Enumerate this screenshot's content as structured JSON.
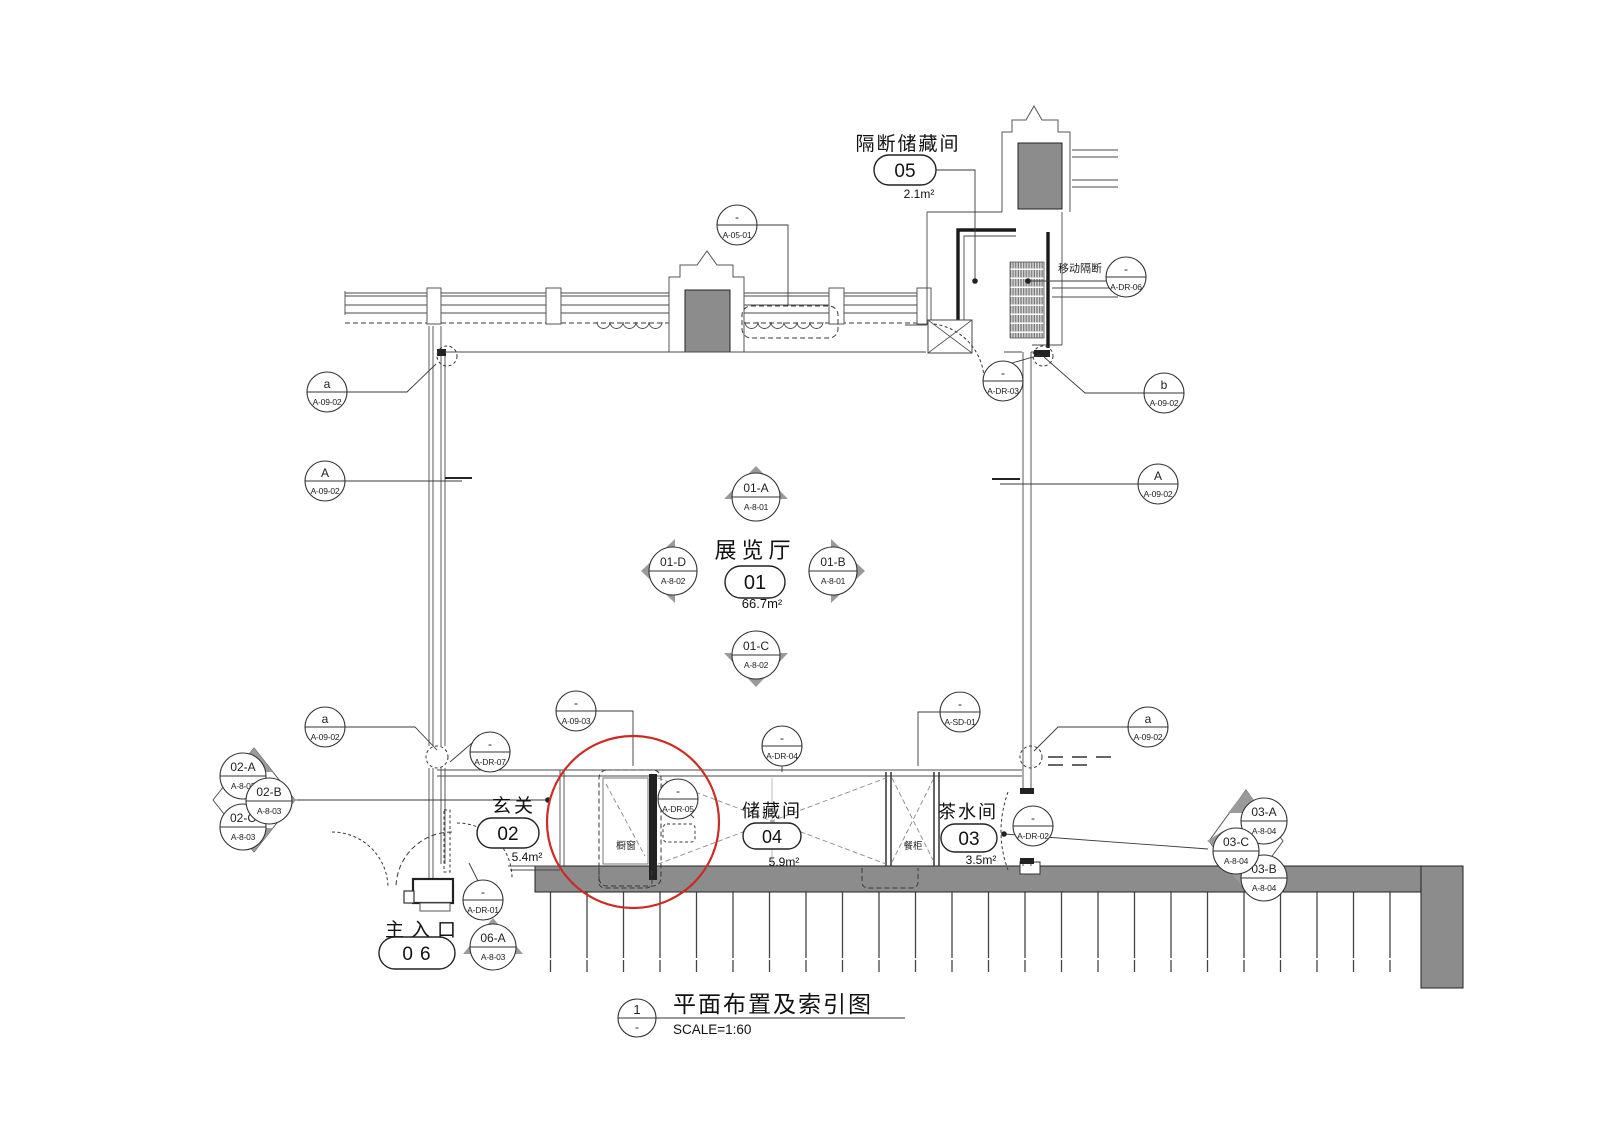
{
  "colors": {
    "line": "#3b3b3b",
    "wall_gray": "#8c8c8c",
    "marker_gray": "#9a9a9a",
    "highlight_red": "#cc2b24"
  },
  "title_block": {
    "number": "1",
    "revision": "-",
    "title": "平面布置及索引图",
    "scale": "SCALE=1:60"
  },
  "rooms": {
    "exhibition": {
      "name": "展览厅",
      "number": "01",
      "area": "66.7m²"
    },
    "entry": {
      "name": "玄关",
      "number": "02",
      "area": "5.4m²"
    },
    "tea": {
      "name": "茶水间",
      "number": "03",
      "area": "3.5m²"
    },
    "storage": {
      "name": "储藏间",
      "number": "04",
      "area": "5.9m²"
    },
    "partition_storage": {
      "name": "隔断储藏间",
      "number": "05",
      "area": "2.1m²"
    },
    "main_entrance": {
      "name": "主入口",
      "number": "06"
    }
  },
  "annotations": {
    "movable_partition": "移动隔断",
    "display_window": "橱窗",
    "sideboard": "餐柜"
  },
  "axis_bubbles": {
    "a_top_left": {
      "label": "a",
      "code": "A-09-02"
    },
    "A_left": {
      "label": "A",
      "code": "A-09-02"
    },
    "b_top_right": {
      "label": "b",
      "code": "A-09-02"
    },
    "A_right": {
      "label": "A",
      "code": "A-09-02"
    },
    "a_bottom_left": {
      "label": "a",
      "code": "A-09-02"
    },
    "a_bottom_right": {
      "label": "a",
      "code": "A-09-02"
    }
  },
  "callouts": {
    "a_05_01": {
      "top": "-",
      "code": "A-05-01"
    },
    "a_dr_06": {
      "top": "-",
      "code": "A-DR-06"
    },
    "a_09_03": {
      "top": "-",
      "code": "A-09-03"
    },
    "a_dr_07": {
      "top": "-",
      "code": "A-DR-07"
    },
    "a_dr_04": {
      "top": "-",
      "code": "A-DR-04"
    },
    "a_sd_01": {
      "top": "-",
      "code": "A-SD-01"
    },
    "a_dr_03": {
      "top": "-",
      "code": "A-DR-03"
    },
    "a_dr_05": {
      "top": "-",
      "code": "A-DR-05"
    },
    "a_dr_02": {
      "top": "-",
      "code": "A-DR-02"
    },
    "a_dr_01": {
      "top": "-",
      "code": "A-DR-01"
    }
  },
  "elevation_markers": {
    "m01a": {
      "label": "01-A",
      "sheet": "A-8-01"
    },
    "m01b": {
      "label": "01-B",
      "sheet": "A-8-01"
    },
    "m01c": {
      "label": "01-C",
      "sheet": "A-8-02"
    },
    "m01d": {
      "label": "01-D",
      "sheet": "A-8-02"
    },
    "m02a": {
      "label": "02-A",
      "sheet": "A-8-03"
    },
    "m02b": {
      "label": "02-B",
      "sheet": "A-8-03"
    },
    "m02c": {
      "label": "02-C",
      "sheet": "A-8-03"
    },
    "m03a": {
      "label": "03-A",
      "sheet": "A-8-04"
    },
    "m03b": {
      "label": "03-B",
      "sheet": "A-8-04"
    },
    "m03c": {
      "label": "03-C",
      "sheet": "A-8-04"
    },
    "m06a": {
      "label": "06-A",
      "sheet": "A-8-03"
    }
  }
}
